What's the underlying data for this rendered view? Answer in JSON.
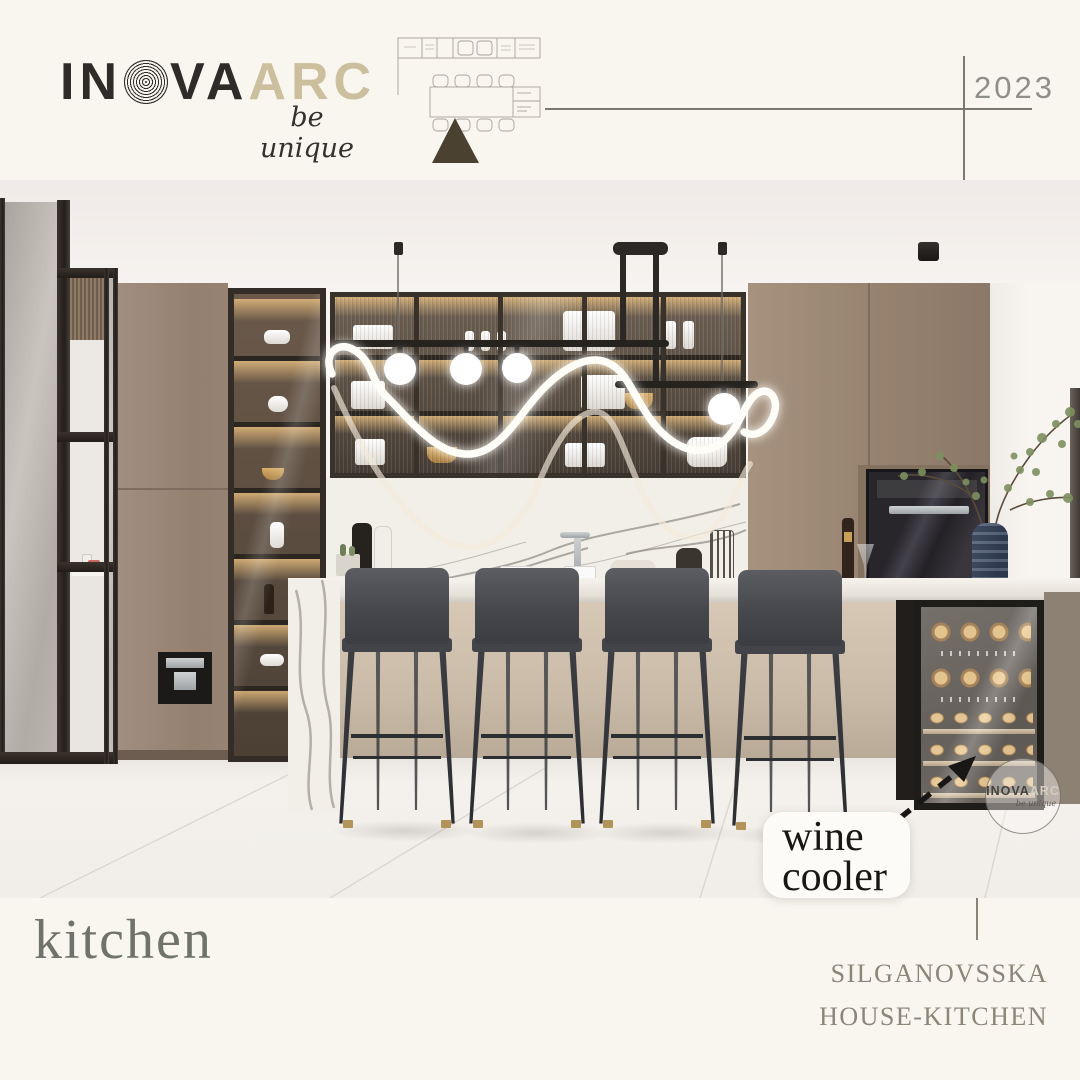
{
  "header": {
    "brand": {
      "part1": "IN",
      "part2": "VA",
      "part3": "ARC",
      "tagline": "be unique"
    },
    "year": "2023"
  },
  "annotation": {
    "line1": "wine",
    "line2": "cooler"
  },
  "watermark": {
    "part1": "INOVA",
    "part2": "ARC",
    "tagline": "be unique"
  },
  "footer": {
    "title": "kitchen",
    "project_line1": "SILGANOVSSKA",
    "project_line2": "HOUSE-KITCHEN"
  },
  "colors": {
    "background_cream": "#f8f6ef",
    "accent_beige": "#cbbf9e",
    "ink": "#2e2b28",
    "triangle_olive": "#4a4130",
    "rule_gray": "#7b7872",
    "year_gray": "#8f8f89",
    "title_gray": "#6f736a",
    "project_taupe": "#8c8578",
    "cabinet_taupe": "#9b8778",
    "label_bg": "#fcfbf8",
    "label_ink": "#181715",
    "wine_glow": "#f3c97e"
  }
}
